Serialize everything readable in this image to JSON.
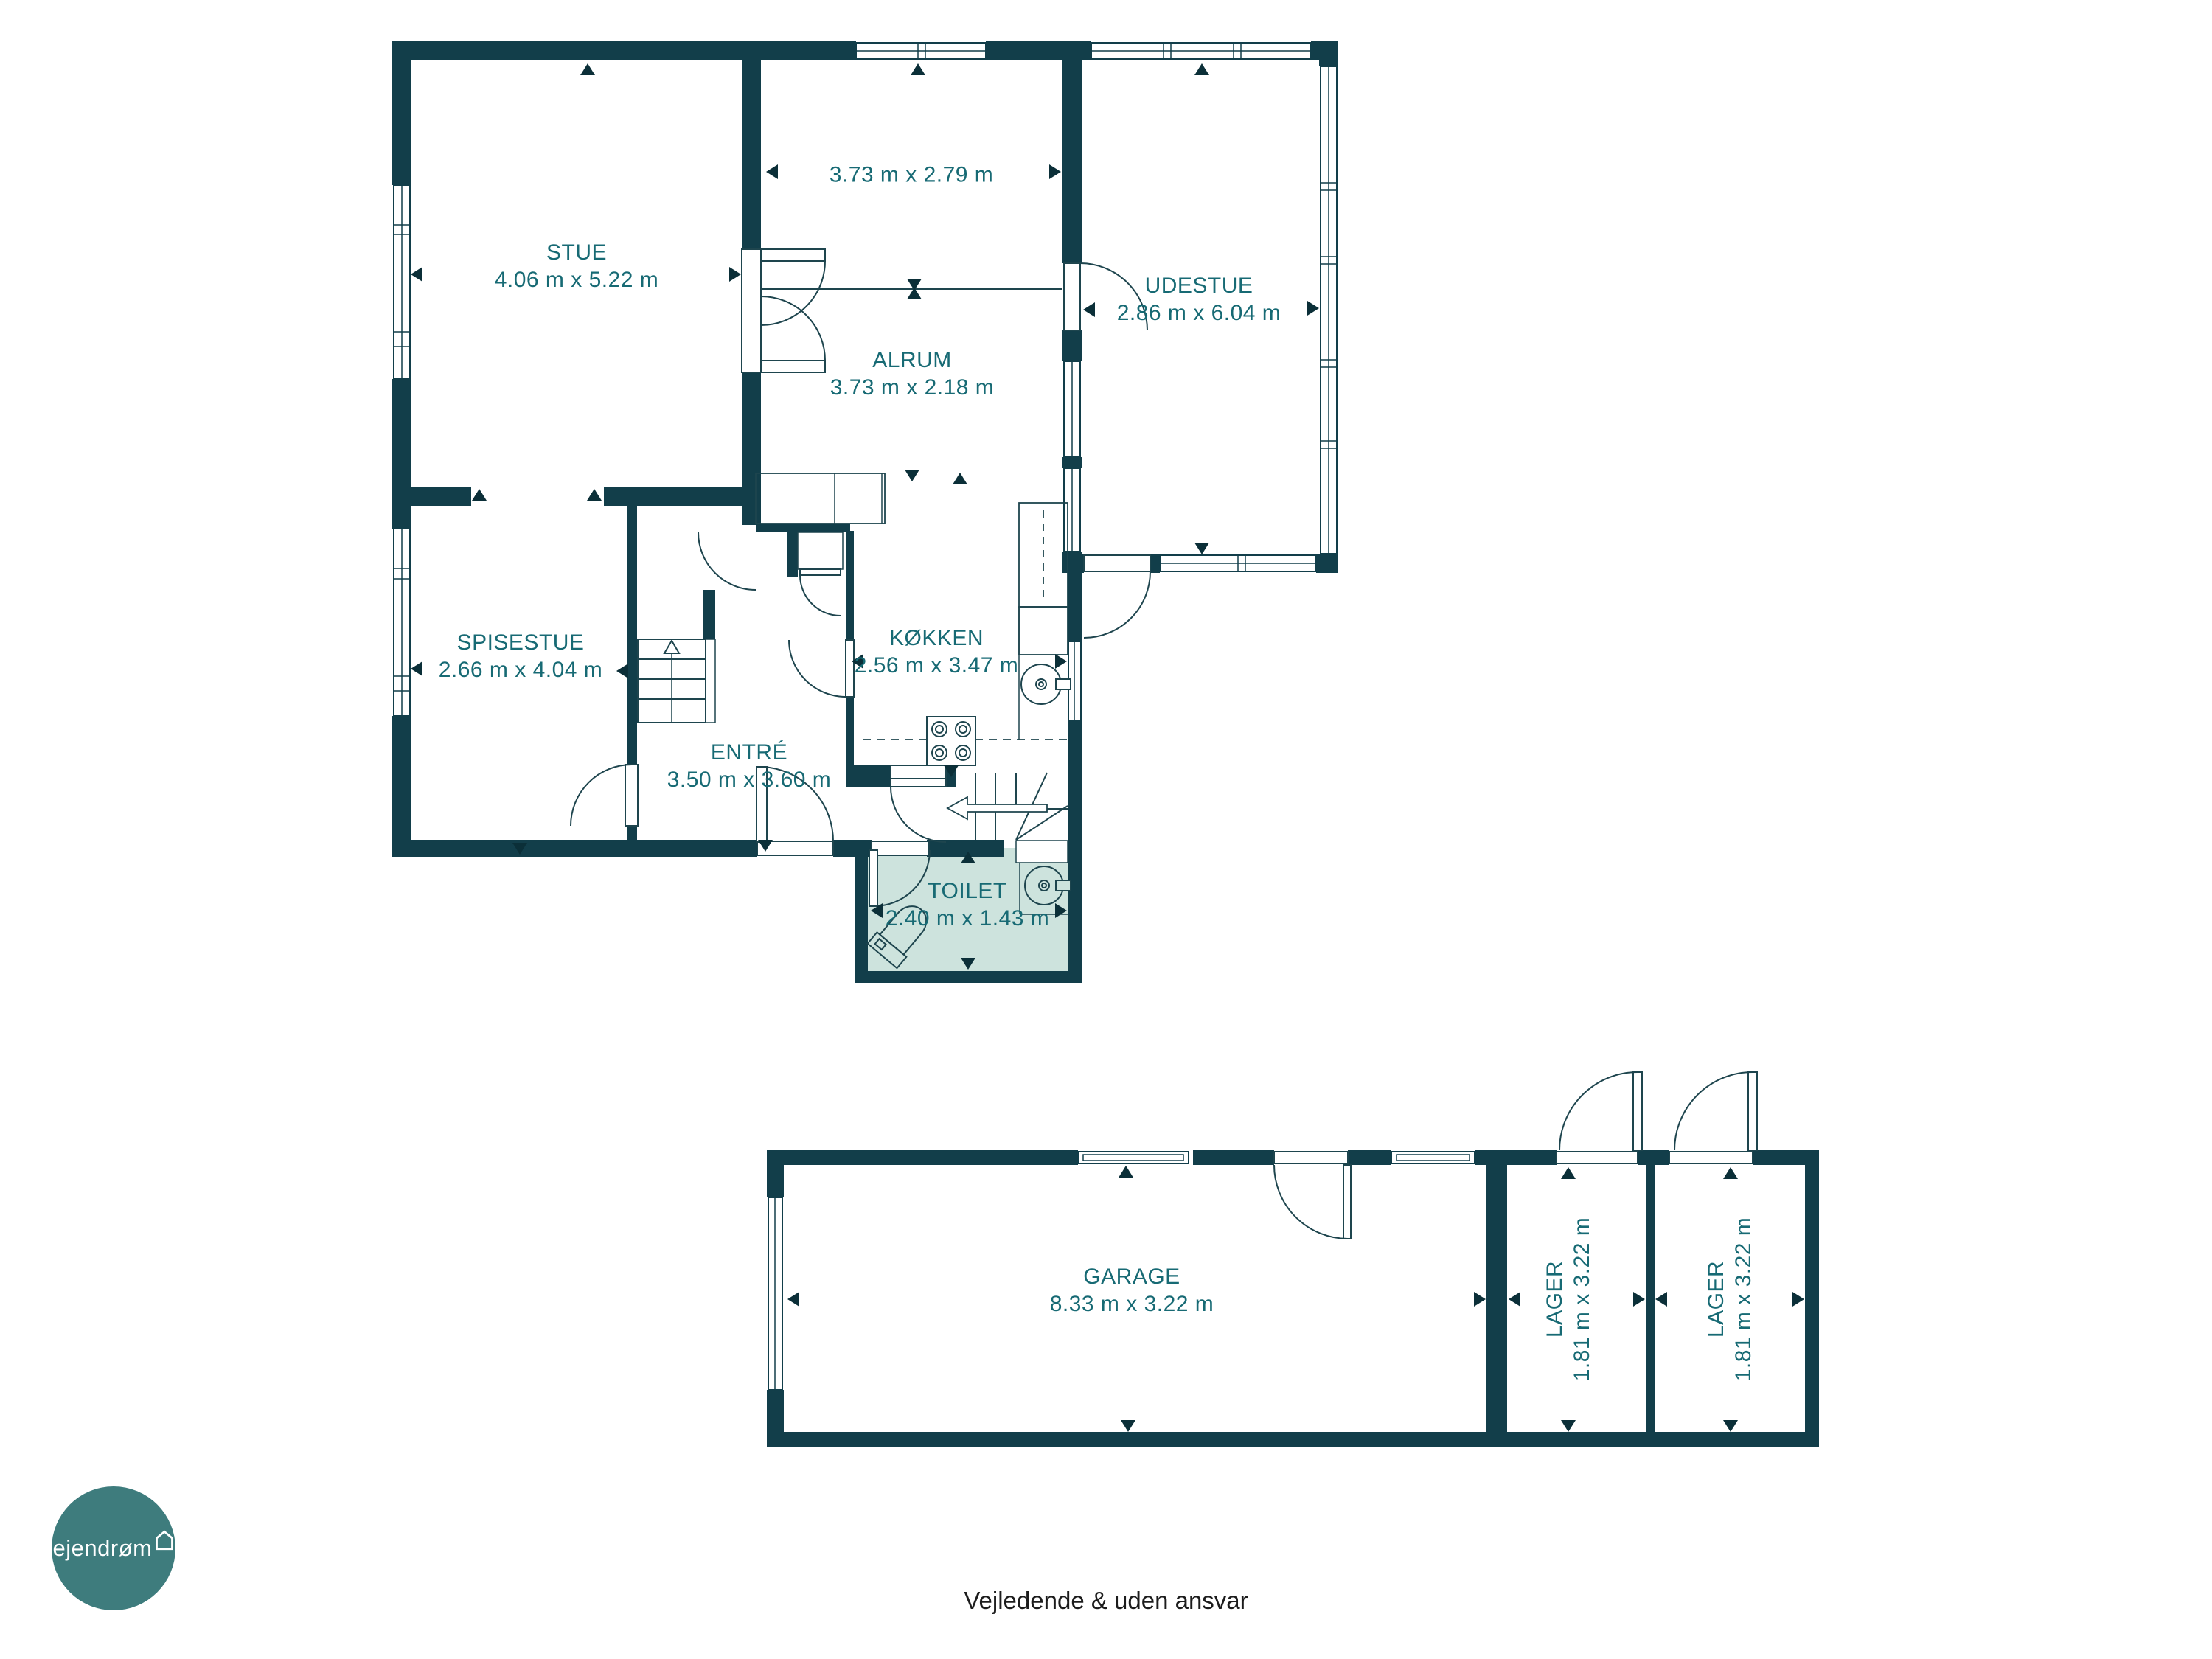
{
  "colors": {
    "wall": "#123e4a",
    "line": "#1e454e",
    "label_text": "#176a74",
    "toilet_fill": "#cde3dd",
    "logo_circle": "#3e7c7d",
    "footer_text": "#1c1c1c"
  },
  "rooms": [
    {
      "id": "stue",
      "name": "STUE",
      "dims": "4.06 m x 5.22 m"
    },
    {
      "id": "alrum",
      "name": "ALRUM",
      "dims": "3.73 m x 2.18 m",
      "extra_dims": "3.73 m x 2.79 m"
    },
    {
      "id": "udestue",
      "name": "UDESTUE",
      "dims": "2.86 m x 6.04 m"
    },
    {
      "id": "spisestue",
      "name": "SPISESTUE",
      "dims": "2.66 m x 4.04 m"
    },
    {
      "id": "kokken",
      "name": "KØKKEN",
      "dims": "2.56 m x 3.47 m"
    },
    {
      "id": "entre",
      "name": "ENTRÉ",
      "dims": "3.50 m x 3.60 m"
    },
    {
      "id": "toilet",
      "name": "TOILET",
      "dims": "2.40 m x 1.43 m"
    },
    {
      "id": "garage",
      "name": "GARAGE",
      "dims": "8.33 m x 3.22 m"
    },
    {
      "id": "lager1",
      "name": "LAGER",
      "dims": "1.81 m x 3.22 m"
    },
    {
      "id": "lager2",
      "name": "LAGER",
      "dims": "1.81 m x 3.22 m"
    }
  ],
  "branding": {
    "logo_text": "ejendrøm"
  },
  "footer": {
    "disclaimer": "Vejledende & uden ansvar"
  }
}
